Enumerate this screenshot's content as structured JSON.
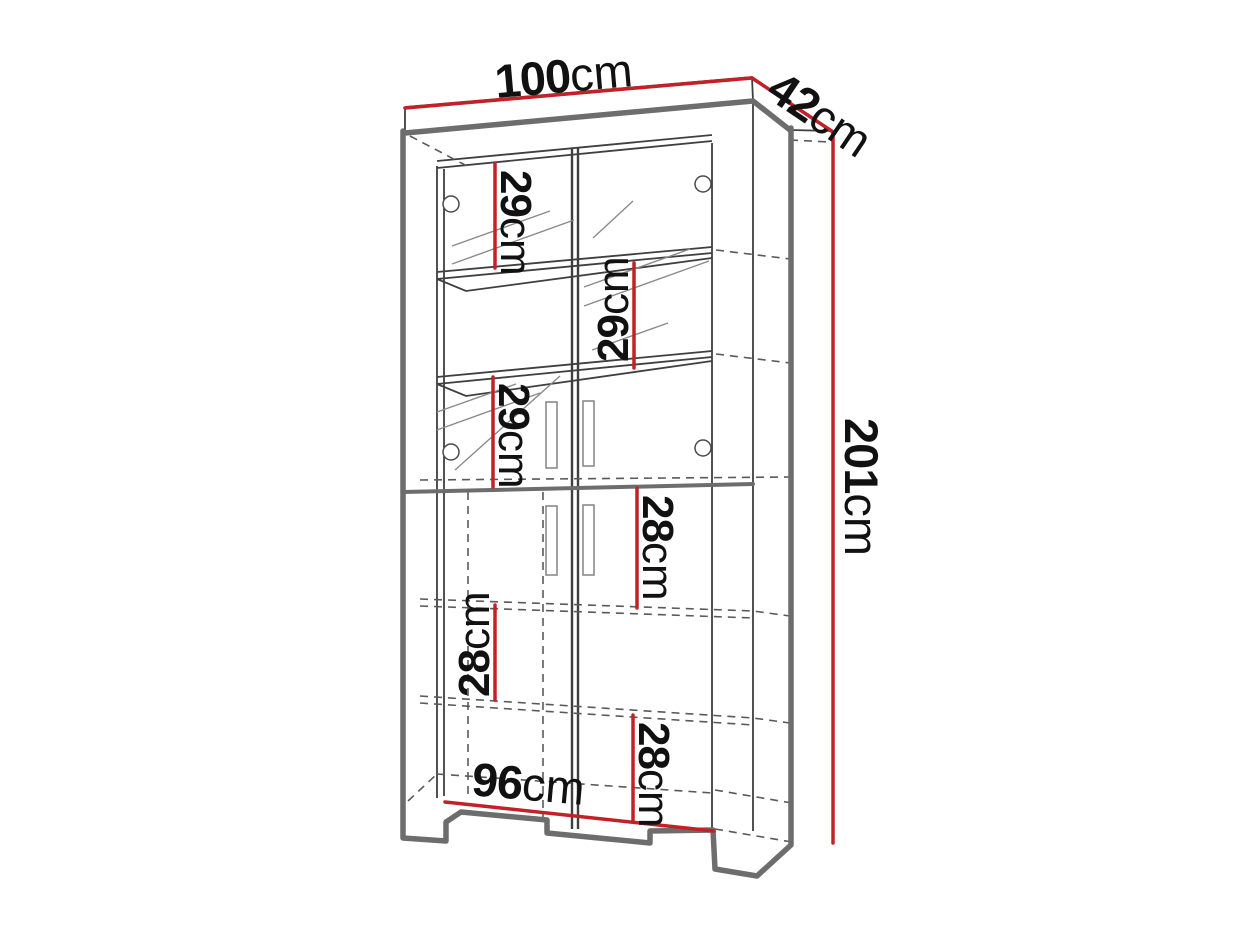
{
  "diagram": {
    "subject": "tall two-door display cabinet dimension drawing",
    "colors": {
      "dimension_line": "#c22127",
      "thick_outline": "#6d6d6d",
      "thin_line": "#3f3f3f",
      "hidden_line": "#5a5a5a",
      "label_text": "#111111",
      "background": "#ffffff"
    },
    "dims": {
      "width_top": {
        "value": "100",
        "unit": "cm"
      },
      "depth": {
        "value": "42",
        "unit": "cm"
      },
      "height": {
        "value": "201",
        "unit": "cm"
      },
      "width_bottom": {
        "value": "96",
        "unit": "cm"
      },
      "shelf_1": {
        "value": "29",
        "unit": "cm"
      },
      "shelf_2": {
        "value": "29",
        "unit": "cm"
      },
      "shelf_3": {
        "value": "29",
        "unit": "cm"
      },
      "shelf_4": {
        "value": "28",
        "unit": "cm"
      },
      "shelf_5": {
        "value": "28",
        "unit": "cm"
      },
      "shelf_6": {
        "value": "28",
        "unit": "cm"
      }
    },
    "shelf_spacings_top_to_bottom": [
      "29cm",
      "29cm",
      "29cm",
      "28cm",
      "28cm",
      "28cm"
    ]
  }
}
